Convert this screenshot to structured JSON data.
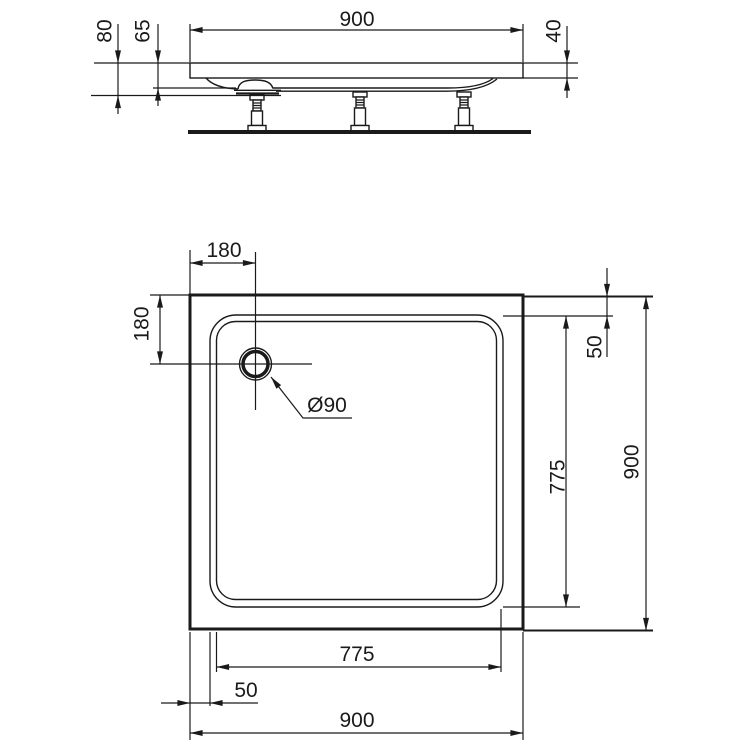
{
  "drawing": {
    "type": "shower-tray-technical-drawing",
    "line_color": "#1a1a1a",
    "background_color": "#ffffff"
  },
  "side_view": {
    "overall_width": "900",
    "total_height": "80",
    "body_height": "65",
    "rim_thickness": "40"
  },
  "plan_view": {
    "drain_offset_horizontal": "180",
    "drain_offset_vertical": "180",
    "drain_diameter": "Ø90",
    "rim_inset_top": "50",
    "basin_length": "775",
    "overall_height": "900",
    "basin_width": "775",
    "rim_inset_left": "50",
    "overall_width": "900"
  }
}
